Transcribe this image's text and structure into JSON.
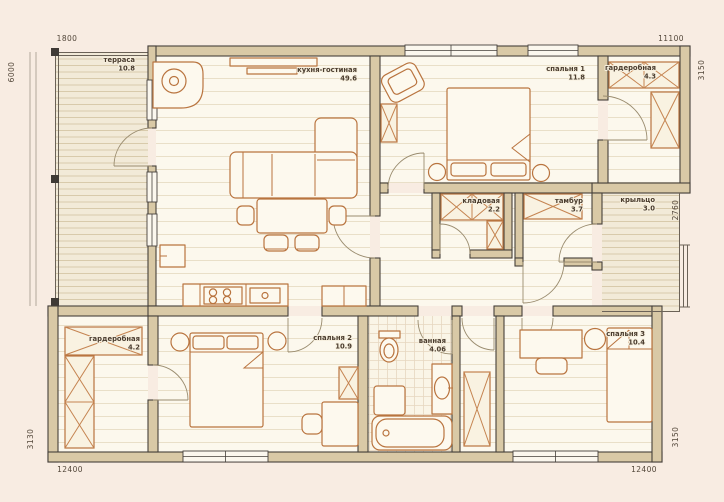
{
  "plan": {
    "title": "house-floor-plan",
    "rooms": {
      "terrace": {
        "name": "терраса",
        "area": "10.8"
      },
      "kitchen_living": {
        "name": "кухня-гостиная",
        "area": "49.6"
      },
      "bedroom1": {
        "name": "спальня 1",
        "area": "11.8"
      },
      "wardrobe_top": {
        "name": "гардеробная",
        "area": "4.3"
      },
      "storage": {
        "name": "кладовая",
        "area": "2.2"
      },
      "vestibule": {
        "name": "тамбур",
        "area": "3.7"
      },
      "porch": {
        "name": "крыльцо",
        "area": "3.0"
      },
      "wardrobe_bottom": {
        "name": "гардеробная",
        "area": "4.2"
      },
      "bedroom2": {
        "name": "спальня 2",
        "area": "10.9"
      },
      "bathroom": {
        "name": "ванная",
        "area": "4.06"
      },
      "bedroom3": {
        "name": "спальня 3",
        "area": "10.4"
      }
    },
    "dimensions": {
      "terrace_width": "1800",
      "house_width_top": "11100",
      "terrace_height": "6000",
      "right_top": "3150",
      "right_middle": "2760",
      "right_bottom": "3150",
      "left_bottom": "3130",
      "bottom_left": "12400",
      "bottom_right": "12400"
    },
    "colors": {
      "background": "#f8ece2",
      "wall_fill": "#d9c9a6",
      "wall_outline": "#45403b",
      "furniture_line": "#b9743f",
      "floor": "#fcf8ed",
      "deck": "#f2ead8",
      "label_text": "#4a3c2e"
    }
  }
}
